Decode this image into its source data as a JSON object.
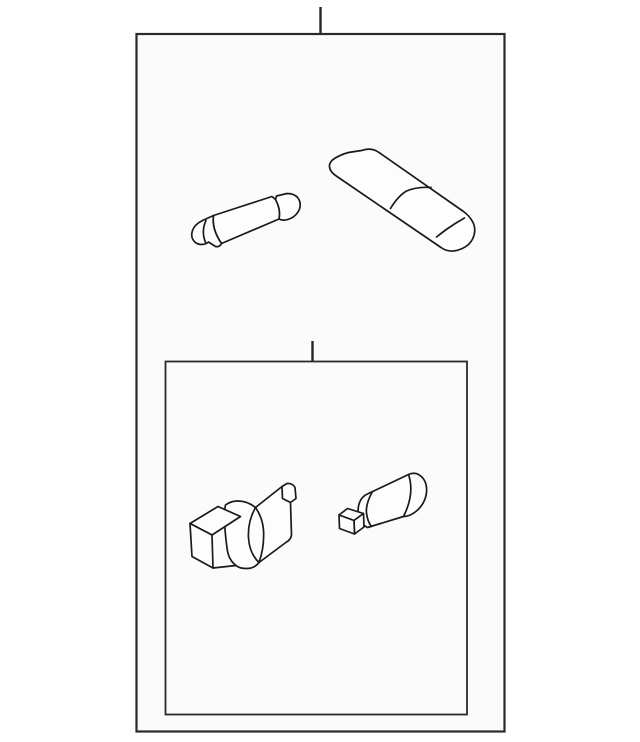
{
  "page": {
    "description": "Black-and-white line-art auto parts kit diagram. An outer kit box (with a callout tick at top) contains a festoon bulb and a lamp lens cover. A smaller inner kit box (with its own callout tick) contains a socket connector with grommet collar and a cylindrical bulb socket. No text labels are present.",
    "background_color": "#ffffff",
    "panel_fill_color": "#fbfbfb",
    "line_color": "#1a1a1a",
    "border_color": "#2a2a2a"
  },
  "panels": {
    "outer_box": {
      "name": "outer kit box",
      "callout": "vertical tick at top center"
    },
    "inner_box": {
      "name": "inner kit box",
      "callout": "vertical tick at top center"
    }
  },
  "parts": {
    "festoon_bulb": {
      "name": "festoon bulb",
      "body": "M213.5,215.5 L272,196.5 L275.5,199.5 L276.5,196 L287,193.5 Q294.5,193.5 298,198 Q301.5,203 299.5,209 Q297,215.5 290.5,218.5 Q283.5,221.5 279,219 L221.5,243.5 Q211.5,229 213.5,215.5 Z",
      "tip": "M213.5,215.5 L202.5,220.5 Q194.5,224.5 192.5,230.5 Q190.5,236.5 193.5,240.5 Q196.5,244.5 201.5,244.5 Q205.5,244.5 208.5,242 L215.5,246.5 Q219.5,247.5 221.5,243.5 Q211.5,229 213.5,215.5 Z",
      "cap_edge": "M275.5,199.5 Q281,209.5 279,219",
      "tip_facet": "M206,220.5 Q201,231 205.5,242.5"
    },
    "lens": {
      "name": "lamp lens cover",
      "outline": "M361.5,150.5 Q371.5,147 379,152.5 L463.5,211.5 Q469.5,216 472.5,221.5 Q475.5,227 474.5,233 Q473.5,239.5 468.5,244.5 Q462,250 453.5,251 Q446.5,251.5 441,247.5 L337,176.5 Q330,172 329.5,167 Q329,162 334.5,158.5 Q341,154.5 348.5,152.5 Z",
      "crease_mid": "M390.5,208.5 Q398,196 406.5,191 Q417,186.5 431,187.5",
      "crease_end": "M436.5,237 Q443.5,231.5 447,229 Q455.5,223 464.5,218"
    },
    "socket_connector": {
      "name": "socket connector with grommet collar",
      "cylinder": "M255.5,507.5 L282,486.5 L287,483.5 Q292.5,483 295,487.5 L296,498.5 L290.5,502.5 L291.5,535 Q291,539.5 286.5,542 L259,562.5 Z",
      "collar": "M225.5,505 Q230,501.5 236.5,501 Q247,500.5 255.5,507.5 Q262.5,517.5 263.5,530 Q264.5,547 259,562.5 Q254.5,568.5 246.5,568.5 Q240.5,568.5 237.5,566.5 Q228.5,561 227,548 Q224.5,529 224.5,517 Q224.5,509 225.5,505 Z",
      "collar_crease": "M255.5,507.5 Q247.5,521.5 248.5,538 Q249.5,553.5 259,562.5",
      "box_top": "M190,523.5 L218,506.5 L240.5,516.5 L212,535 Z",
      "box_front": "M190,523.5 L212,535 L213,568 L192,556.5 Z",
      "bottom_edge": "M213,568 L236,565.5",
      "tab_fold": "M282,486.5 L282.5,498.5 L290.5,502.5"
    },
    "bulb_socket": {
      "name": "cylindrical bulb socket",
      "cylinder": "M368.5,493.5 L408.5,474.5 Q414,472 418.5,474.5 Q424.5,478 426,484.5 Q427.5,491 425.5,497.5 Q423,505.5 416.5,511 Q410,516.5 403.5,516.5 L367.5,527.5 Q361,524.5 359,517 Q357,509.5 359.5,502.5 Q362,496 368.5,493.5 Z",
      "end_face": "M408.5,474.5 Q415,493.5 403.5,516.5",
      "left_arc": "M372.5,491.5 Q365.5,504 366.5,513 Q367.5,521.5 371.5,526.5",
      "stub_front": "M339,515 L354,520.5 L354.5,534 L339.5,528.5 Z",
      "stub_top": "M339,515 L347.5,508.5 L363.5,513.5 L354,520.5 Z",
      "stub_side": "M354,520.5 L363.5,513.5 L364,527 L354.5,534 Z"
    }
  }
}
